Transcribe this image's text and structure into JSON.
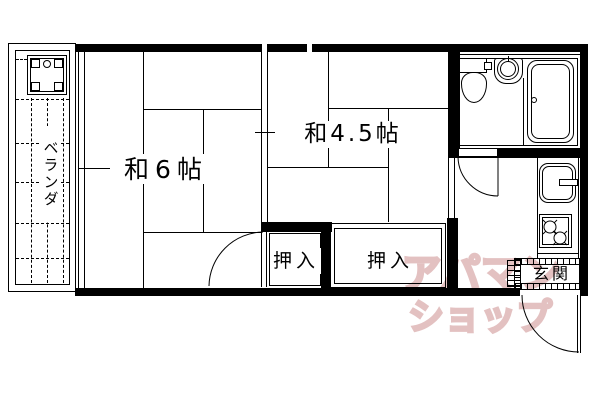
{
  "plan": {
    "type": "apartment-floor-plan",
    "rooms": [
      {
        "name": "japanese-room-6jo",
        "label": "和6帖"
      },
      {
        "name": "japanese-room-4.5jo",
        "label": "和4.5帖"
      }
    ],
    "closets": [
      {
        "name": "oshiire-left",
        "label": "押入"
      },
      {
        "name": "oshiire-right",
        "label": "押入"
      }
    ],
    "entrance": {
      "label": "玄関"
    },
    "veranda": {
      "label": "ベランダ"
    },
    "fixtures": {
      "icons": [
        "washing-machine-pan-icon",
        "toilet-icon",
        "wash-basin-icon",
        "bathtub-icon",
        "kitchen-sink-icon",
        "gas-stove-icon",
        "door-swing-icon"
      ]
    },
    "watermark": {
      "line1": "アパマン",
      "line2": "ショップ",
      "color": "#e3c1c1"
    },
    "colors": {
      "line": "#000000",
      "background": "#ffffff"
    }
  }
}
